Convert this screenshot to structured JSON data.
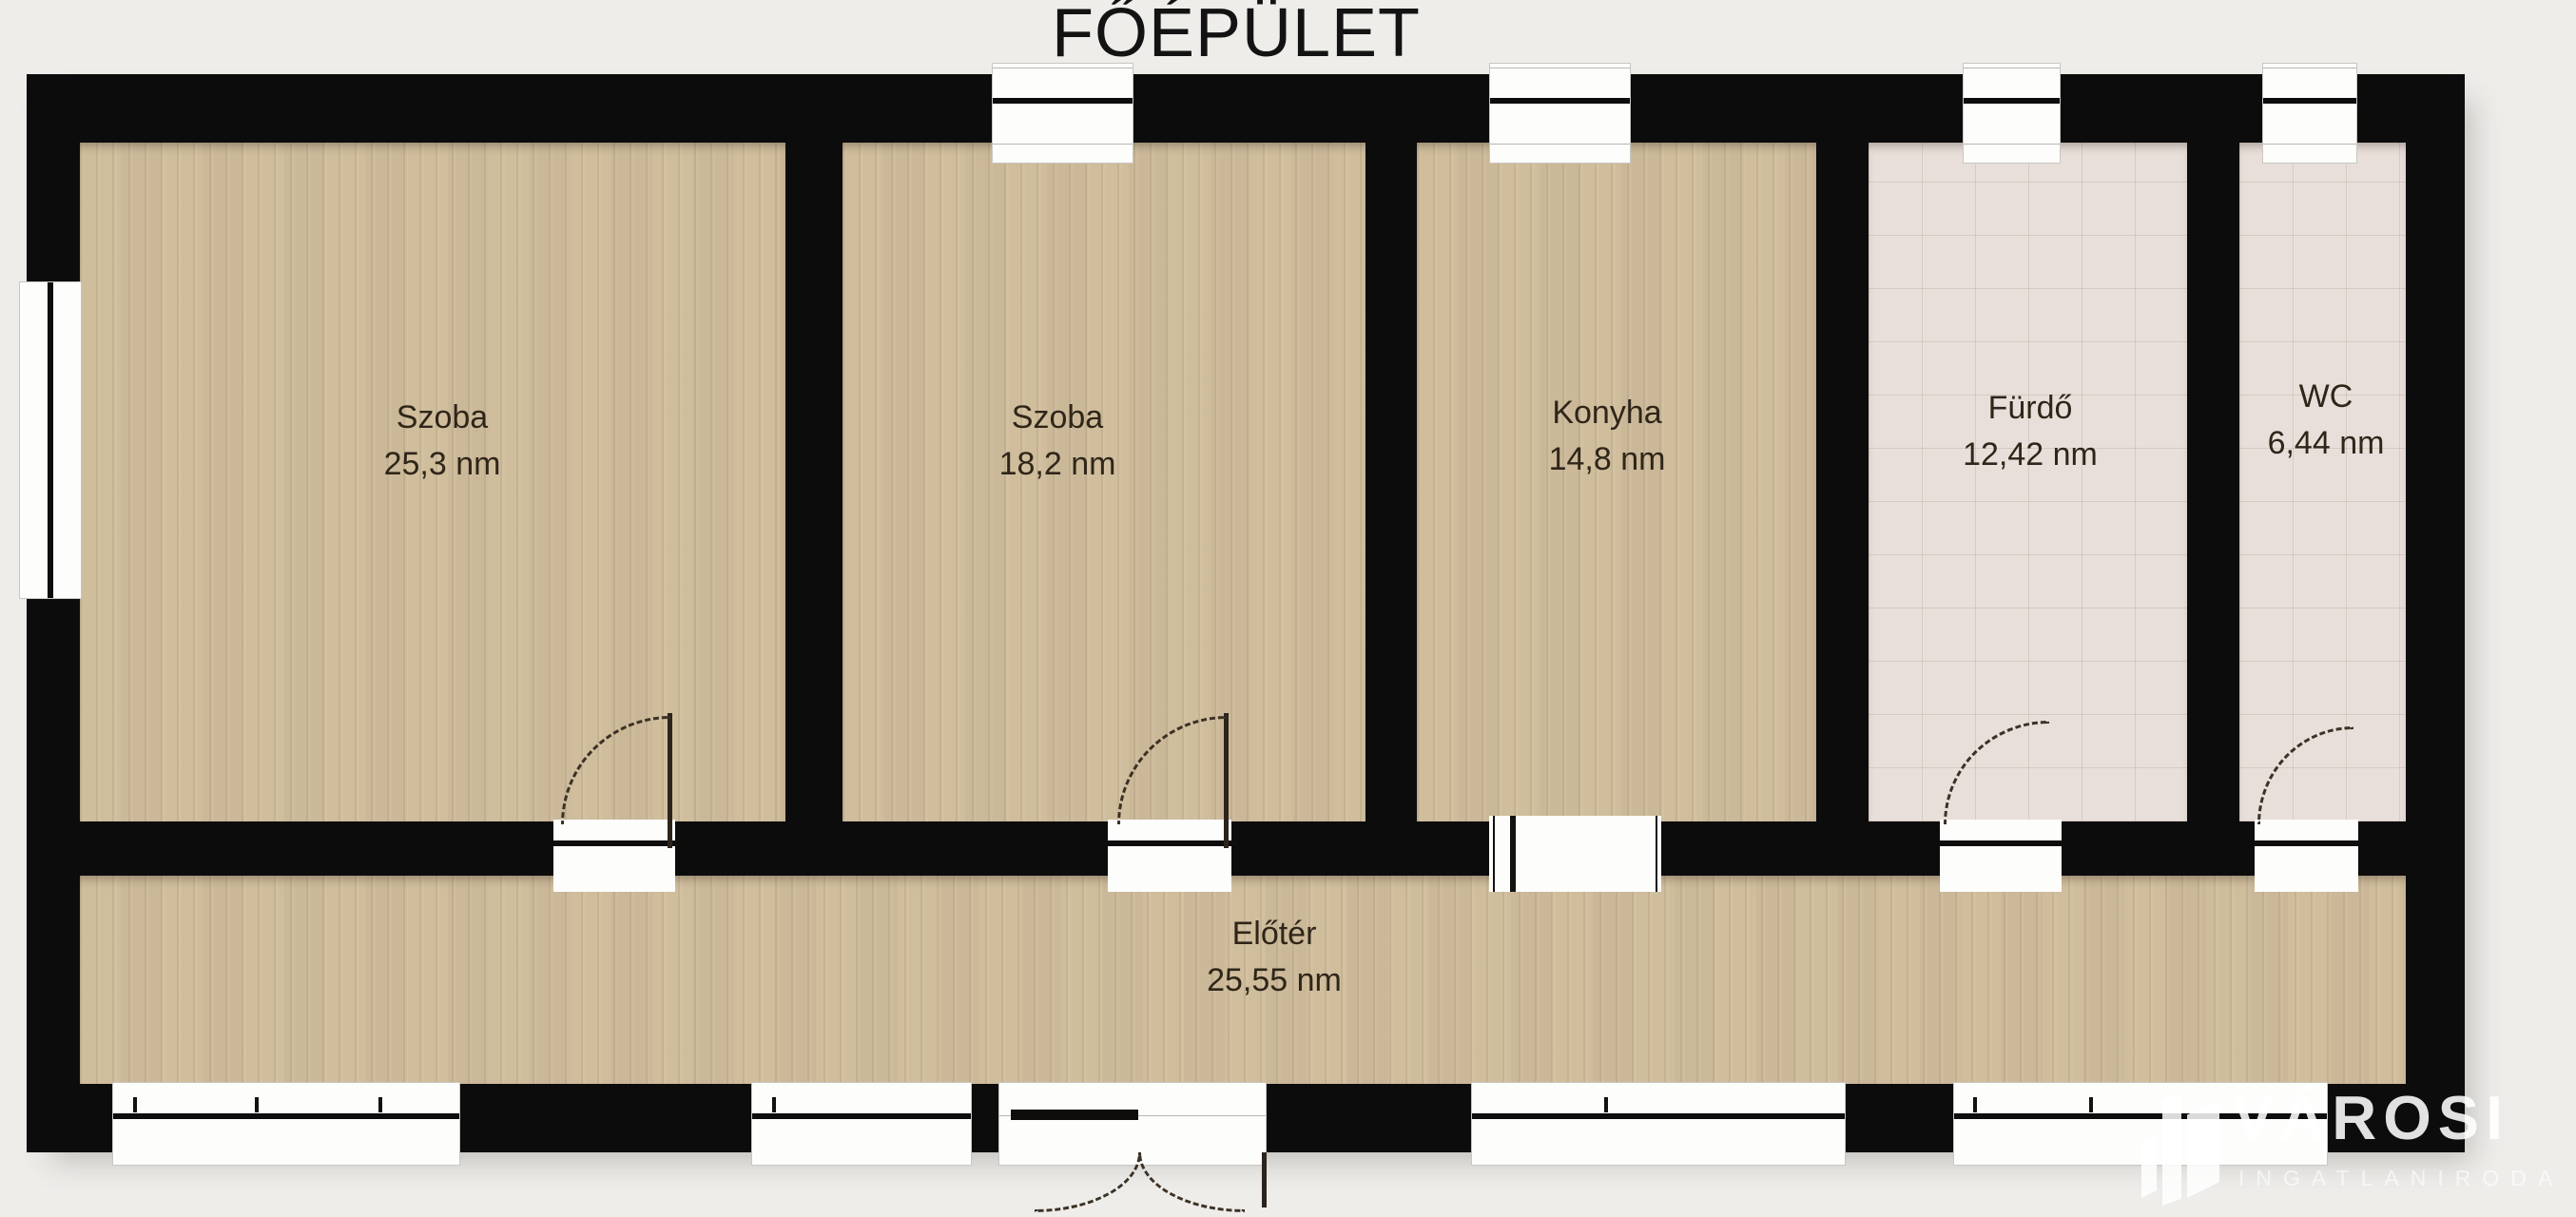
{
  "title": "FŐÉPÜLET",
  "rooms": [
    {
      "id": "szoba-1",
      "name": "Szoba",
      "area": "25,3 nm"
    },
    {
      "id": "szoba-2",
      "name": "Szoba",
      "area": "18,2 nm"
    },
    {
      "id": "konyha",
      "name": "Konyha",
      "area": "14,8 nm"
    },
    {
      "id": "furdo",
      "name": "Fürdő",
      "area": "12,42 nm"
    },
    {
      "id": "wc",
      "name": "WC",
      "area": "6,44 nm"
    },
    {
      "id": "eloter",
      "name": "Előtér",
      "area": "25,55 nm"
    }
  ],
  "watermark": {
    "brand": "VÁROSI",
    "tagline": "INGATLANIRODA"
  },
  "colors": {
    "background": "#eeedea",
    "wall": "#0c0c0c",
    "wood_floor": "#d6c4a3",
    "tile_floor": "#e9dfda",
    "opening": "#fdfdfc",
    "label_text": "#2f2619",
    "watermark_text": "#ffffff"
  }
}
